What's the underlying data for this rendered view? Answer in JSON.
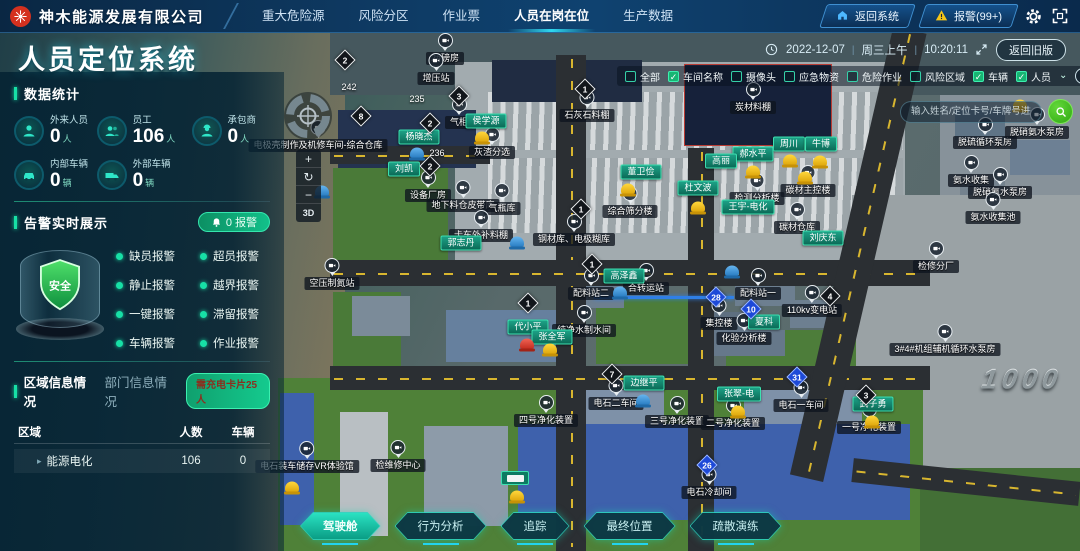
{
  "header": {
    "company": "神木能源发展有限公司",
    "nav": [
      {
        "label": "重大危险源",
        "active": false
      },
      {
        "label": "风险分区",
        "active": false
      },
      {
        "label": "作业票",
        "active": false
      },
      {
        "label": "人员在岗在位",
        "active": true
      },
      {
        "label": "生产数据",
        "active": false
      }
    ],
    "back_system_label": "返回系统",
    "alarm_label": "报警(99+)"
  },
  "titlebar": {
    "page_title": "人员定位系统",
    "date": "2022-12-07",
    "weekday": "周三上午",
    "time": "10:20:11",
    "back_old_label": "返回旧版"
  },
  "stats": {
    "section_title": "数据统计",
    "items": [
      {
        "label": "外来人员",
        "value": "0",
        "unit": "人",
        "icon": "person"
      },
      {
        "label": "员工",
        "value": "106",
        "unit": "人",
        "icon": "users"
      },
      {
        "label": "承包商",
        "value": "0",
        "unit": "人",
        "icon": "contractor"
      },
      {
        "label": "内部车辆",
        "value": "0",
        "unit": "辆",
        "icon": "car"
      },
      {
        "label": "外部车辆",
        "value": "0",
        "unit": "辆",
        "icon": "truck"
      }
    ]
  },
  "alarms": {
    "section_title": "告警实时展示",
    "count_badge": "0 报警",
    "shield_label": "安全",
    "types": [
      "缺员报警",
      "超员报警",
      "静止报警",
      "越界报警",
      "一键报警",
      "滞留报警",
      "车辆报警",
      "作业报警"
    ]
  },
  "region_info": {
    "tabs": [
      {
        "label": "区域信息情况",
        "active": true
      },
      {
        "label": "部门信息情况",
        "active": false
      }
    ],
    "charge_badge": "需充电卡片25人",
    "table": {
      "headers": [
        "区域",
        "人数",
        "车辆"
      ],
      "rows": [
        [
          "能源电化",
          "106",
          "0"
        ]
      ]
    }
  },
  "map": {
    "filters": [
      {
        "label": "全部",
        "checked": false
      },
      {
        "label": "车间名称",
        "checked": true
      },
      {
        "label": "摄像头",
        "checked": false
      },
      {
        "label": "应急物资",
        "checked": false
      },
      {
        "label": "危险作业",
        "checked": false
      },
      {
        "label": "风险区域",
        "checked": false
      },
      {
        "label": "车辆",
        "checked": true
      },
      {
        "label": "人员",
        "checked": true
      }
    ],
    "search_placeholder": "输入姓名/定位卡号/车牌号进行查找",
    "controls": {
      "zoom_in": "+",
      "reset": "↻",
      "zoom_out": "−",
      "mode_3d": "3D"
    },
    "buildings": [
      {
        "text": "2#磅房",
        "x": 445,
        "y": 59
      },
      {
        "text": "增压站",
        "x": 436,
        "y": 79
      },
      {
        "text": "石灰石料棚",
        "x": 587,
        "y": 116
      },
      {
        "text": "炭材料棚",
        "x": 753,
        "y": 108
      },
      {
        "text": "气柜",
        "x": 459,
        "y": 123
      },
      {
        "text": "电极壳制作及机修车间-综合仓库",
        "x": 318,
        "y": 146
      },
      {
        "text": "灰渣分选",
        "x": 492,
        "y": 153
      },
      {
        "text": "设备厂房",
        "x": 428,
        "y": 196
      },
      {
        "text": "地下料仓皮带库",
        "x": 463,
        "y": 206
      },
      {
        "text": "气瓶库",
        "x": 502,
        "y": 209
      },
      {
        "text": "卡车外补料棚",
        "x": 481,
        "y": 236
      },
      {
        "text": "钢材库、电极糊库",
        "x": 574,
        "y": 240
      },
      {
        "text": "综合筛分楼",
        "x": 630,
        "y": 212
      },
      {
        "text": "检测分析楼",
        "x": 757,
        "y": 199
      },
      {
        "text": "碳材主控楼",
        "x": 808,
        "y": 191
      },
      {
        "text": "碳材仓库",
        "x": 797,
        "y": 228
      },
      {
        "text": "空压制氮站",
        "x": 332,
        "y": 284
      },
      {
        "text": "配料站二",
        "x": 591,
        "y": 294
      },
      {
        "text": "合转运站",
        "x": 646,
        "y": 289
      },
      {
        "text": "配料站一",
        "x": 758,
        "y": 294
      },
      {
        "text": "集控楼",
        "x": 719,
        "y": 324
      },
      {
        "text": "化验分析楼",
        "x": 744,
        "y": 339
      },
      {
        "text": "110kv变电站",
        "x": 812,
        "y": 311
      },
      {
        "text": "纯净水制水间",
        "x": 584,
        "y": 331
      },
      {
        "text": "检修分厂",
        "x": 936,
        "y": 267
      },
      {
        "text": "3#4#机组辅机循环水泵房",
        "x": 945,
        "y": 350
      },
      {
        "text": "脱硫循环泵房",
        "x": 985,
        "y": 143
      },
      {
        "text": "脱硝氨水泵房",
        "x": 1037,
        "y": 133
      },
      {
        "text": "氨水收集",
        "x": 971,
        "y": 181
      },
      {
        "text": "脱硝氨水泵房",
        "x": 1000,
        "y": 193
      },
      {
        "text": "氨水收集池",
        "x": 993,
        "y": 218
      },
      {
        "text": "电石二车间",
        "x": 616,
        "y": 404
      },
      {
        "text": "四号净化装置",
        "x": 546,
        "y": 421
      },
      {
        "text": "三号净化装置",
        "x": 677,
        "y": 422
      },
      {
        "text": "二号净化装置",
        "x": 733,
        "y": 424
      },
      {
        "text": "电石一车间",
        "x": 801,
        "y": 406
      },
      {
        "text": "一号净化装置",
        "x": 869,
        "y": 428
      },
      {
        "text": "电石冷却间",
        "x": 709,
        "y": 493
      },
      {
        "text": "检维修中心",
        "x": 398,
        "y": 466
      },
      {
        "text": "电石装车储存VR体验馆",
        "x": 307,
        "y": 467
      }
    ],
    "persons": [
      {
        "name": "杨晓杰",
        "x": 419,
        "y": 137
      },
      {
        "name": "侯学源",
        "x": 486,
        "y": 121
      },
      {
        "name": "刘凯",
        "x": 404,
        "y": 169
      },
      {
        "name": "董卫俭",
        "x": 641,
        "y": 172
      },
      {
        "name": "杜文波",
        "x": 698,
        "y": 188
      },
      {
        "name": "王宇-电化",
        "x": 748,
        "y": 207
      },
      {
        "name": "周川",
        "x": 789,
        "y": 144
      },
      {
        "name": "牛博",
        "x": 821,
        "y": 144
      },
      {
        "name": "郝水平",
        "x": 753,
        "y": 154
      },
      {
        "name": "高丽",
        "x": 721,
        "y": 161
      },
      {
        "name": "刘庆东",
        "x": 823,
        "y": 238
      },
      {
        "name": "郭志丹",
        "x": 461,
        "y": 243
      },
      {
        "name": "高泽鑫",
        "x": 624,
        "y": 276
      },
      {
        "name": "代小平",
        "x": 528,
        "y": 327
      },
      {
        "name": "张全军",
        "x": 552,
        "y": 337
      },
      {
        "name": "夏科",
        "x": 764,
        "y": 322
      },
      {
        "name": "边继平",
        "x": 644,
        "y": 383
      },
      {
        "name": "张翠-电",
        "x": 739,
        "y": 394
      },
      {
        "name": "武子勇",
        "x": 873,
        "y": 404
      }
    ],
    "diamonds": [
      {
        "n": "2",
        "x": 345,
        "y": 60,
        "blue": false
      },
      {
        "n": "3",
        "x": 459,
        "y": 96,
        "blue": false
      },
      {
        "n": "8",
        "x": 361,
        "y": 116,
        "blue": false
      },
      {
        "n": "2",
        "x": 430,
        "y": 123,
        "blue": false
      },
      {
        "n": "2",
        "x": 430,
        "y": 166,
        "blue": false
      },
      {
        "n": "1",
        "x": 585,
        "y": 89,
        "blue": false
      },
      {
        "n": "1",
        "x": 581,
        "y": 209,
        "blue": false
      },
      {
        "n": "1",
        "x": 592,
        "y": 264,
        "blue": false
      },
      {
        "n": "1",
        "x": 528,
        "y": 303,
        "blue": false
      },
      {
        "n": "7",
        "x": 612,
        "y": 374,
        "blue": false
      },
      {
        "n": "4",
        "x": 830,
        "y": 296,
        "blue": false
      },
      {
        "n": "3",
        "x": 866,
        "y": 395,
        "blue": false
      },
      {
        "n": "28",
        "x": 716,
        "y": 297,
        "blue": true
      },
      {
        "n": "10",
        "x": 751,
        "y": 309,
        "blue": true
      },
      {
        "n": "31",
        "x": 797,
        "y": 377,
        "blue": true
      },
      {
        "n": "26",
        "x": 707,
        "y": 465,
        "blue": true
      }
    ],
    "ground_texts": [
      {
        "text": "242",
        "x": 349,
        "y": 87,
        "big": false
      },
      {
        "text": "235",
        "x": 417,
        "y": 99,
        "big": false
      },
      {
        "text": "236",
        "x": 437,
        "y": 153,
        "big": false
      },
      {
        "text": "1000",
        "x": 1022,
        "y": 380,
        "big": true
      }
    ],
    "helmets": [
      {
        "c": "yellow",
        "x": 482,
        "y": 138
      },
      {
        "c": "yellow",
        "x": 790,
        "y": 161
      },
      {
        "c": "yellow",
        "x": 820,
        "y": 162
      },
      {
        "c": "yellow",
        "x": 753,
        "y": 172
      },
      {
        "c": "yellow",
        "x": 805,
        "y": 178
      },
      {
        "c": "yellow",
        "x": 698,
        "y": 208
      },
      {
        "c": "yellow",
        "x": 628,
        "y": 190
      },
      {
        "c": "yellow",
        "x": 550,
        "y": 350
      },
      {
        "c": "yellow",
        "x": 738,
        "y": 412
      },
      {
        "c": "yellow",
        "x": 872,
        "y": 422
      },
      {
        "c": "yellow",
        "x": 517,
        "y": 497
      },
      {
        "c": "yellow",
        "x": 292,
        "y": 488
      },
      {
        "c": "yellow",
        "x": 1020,
        "y": 106
      },
      {
        "c": "blue",
        "x": 417,
        "y": 154
      },
      {
        "c": "blue",
        "x": 322,
        "y": 192
      },
      {
        "c": "blue",
        "x": 517,
        "y": 243
      },
      {
        "c": "blue",
        "x": 620,
        "y": 293
      },
      {
        "c": "blue",
        "x": 732,
        "y": 272
      },
      {
        "c": "blue",
        "x": 643,
        "y": 401
      },
      {
        "c": "red",
        "x": 527,
        "y": 345
      }
    ],
    "plates": [
      {
        "x": 515,
        "y": 478
      }
    ],
    "actions": [
      {
        "label": "驾驶舱",
        "active": true
      },
      {
        "label": "行为分析",
        "active": false
      },
      {
        "label": "追踪",
        "active": false
      },
      {
        "label": "最终位置",
        "active": false
      },
      {
        "label": "疏散演练",
        "active": false
      }
    ]
  }
}
